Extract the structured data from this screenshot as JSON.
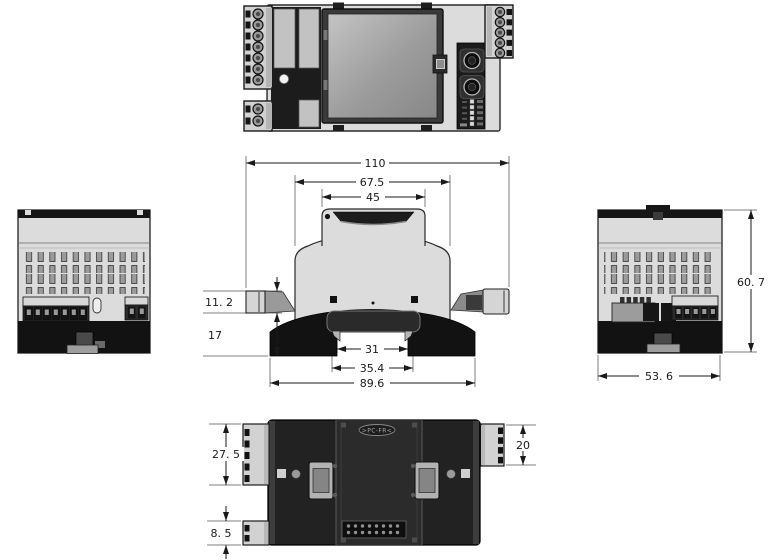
{
  "drawing": {
    "type": "mechanical-dimension-drawing",
    "views": [
      "front",
      "top",
      "left-side",
      "right-side",
      "bottom"
    ]
  },
  "dims": {
    "overall_width": "110",
    "housing_width": "67.5",
    "cap_width": "45",
    "din_notch_width": "31",
    "din_clip_width": "35.4",
    "base_width": "89.6",
    "connector_tab_height": "11. 2",
    "base_section_height": "17",
    "overall_depth": "60. 7",
    "housing_depth": "53. 6",
    "upper_terminal_depth": "27. 5",
    "lower_terminal_depth": "8. 5",
    "right_terminal_depth": "20"
  },
  "labels": {
    "material_marking": ">PC-FR<"
  },
  "colors": {
    "background": "#ffffff",
    "housing_light": "#dcdcdc",
    "housing_dark": "#141414",
    "dimension_line": "#1a1a1a"
  }
}
